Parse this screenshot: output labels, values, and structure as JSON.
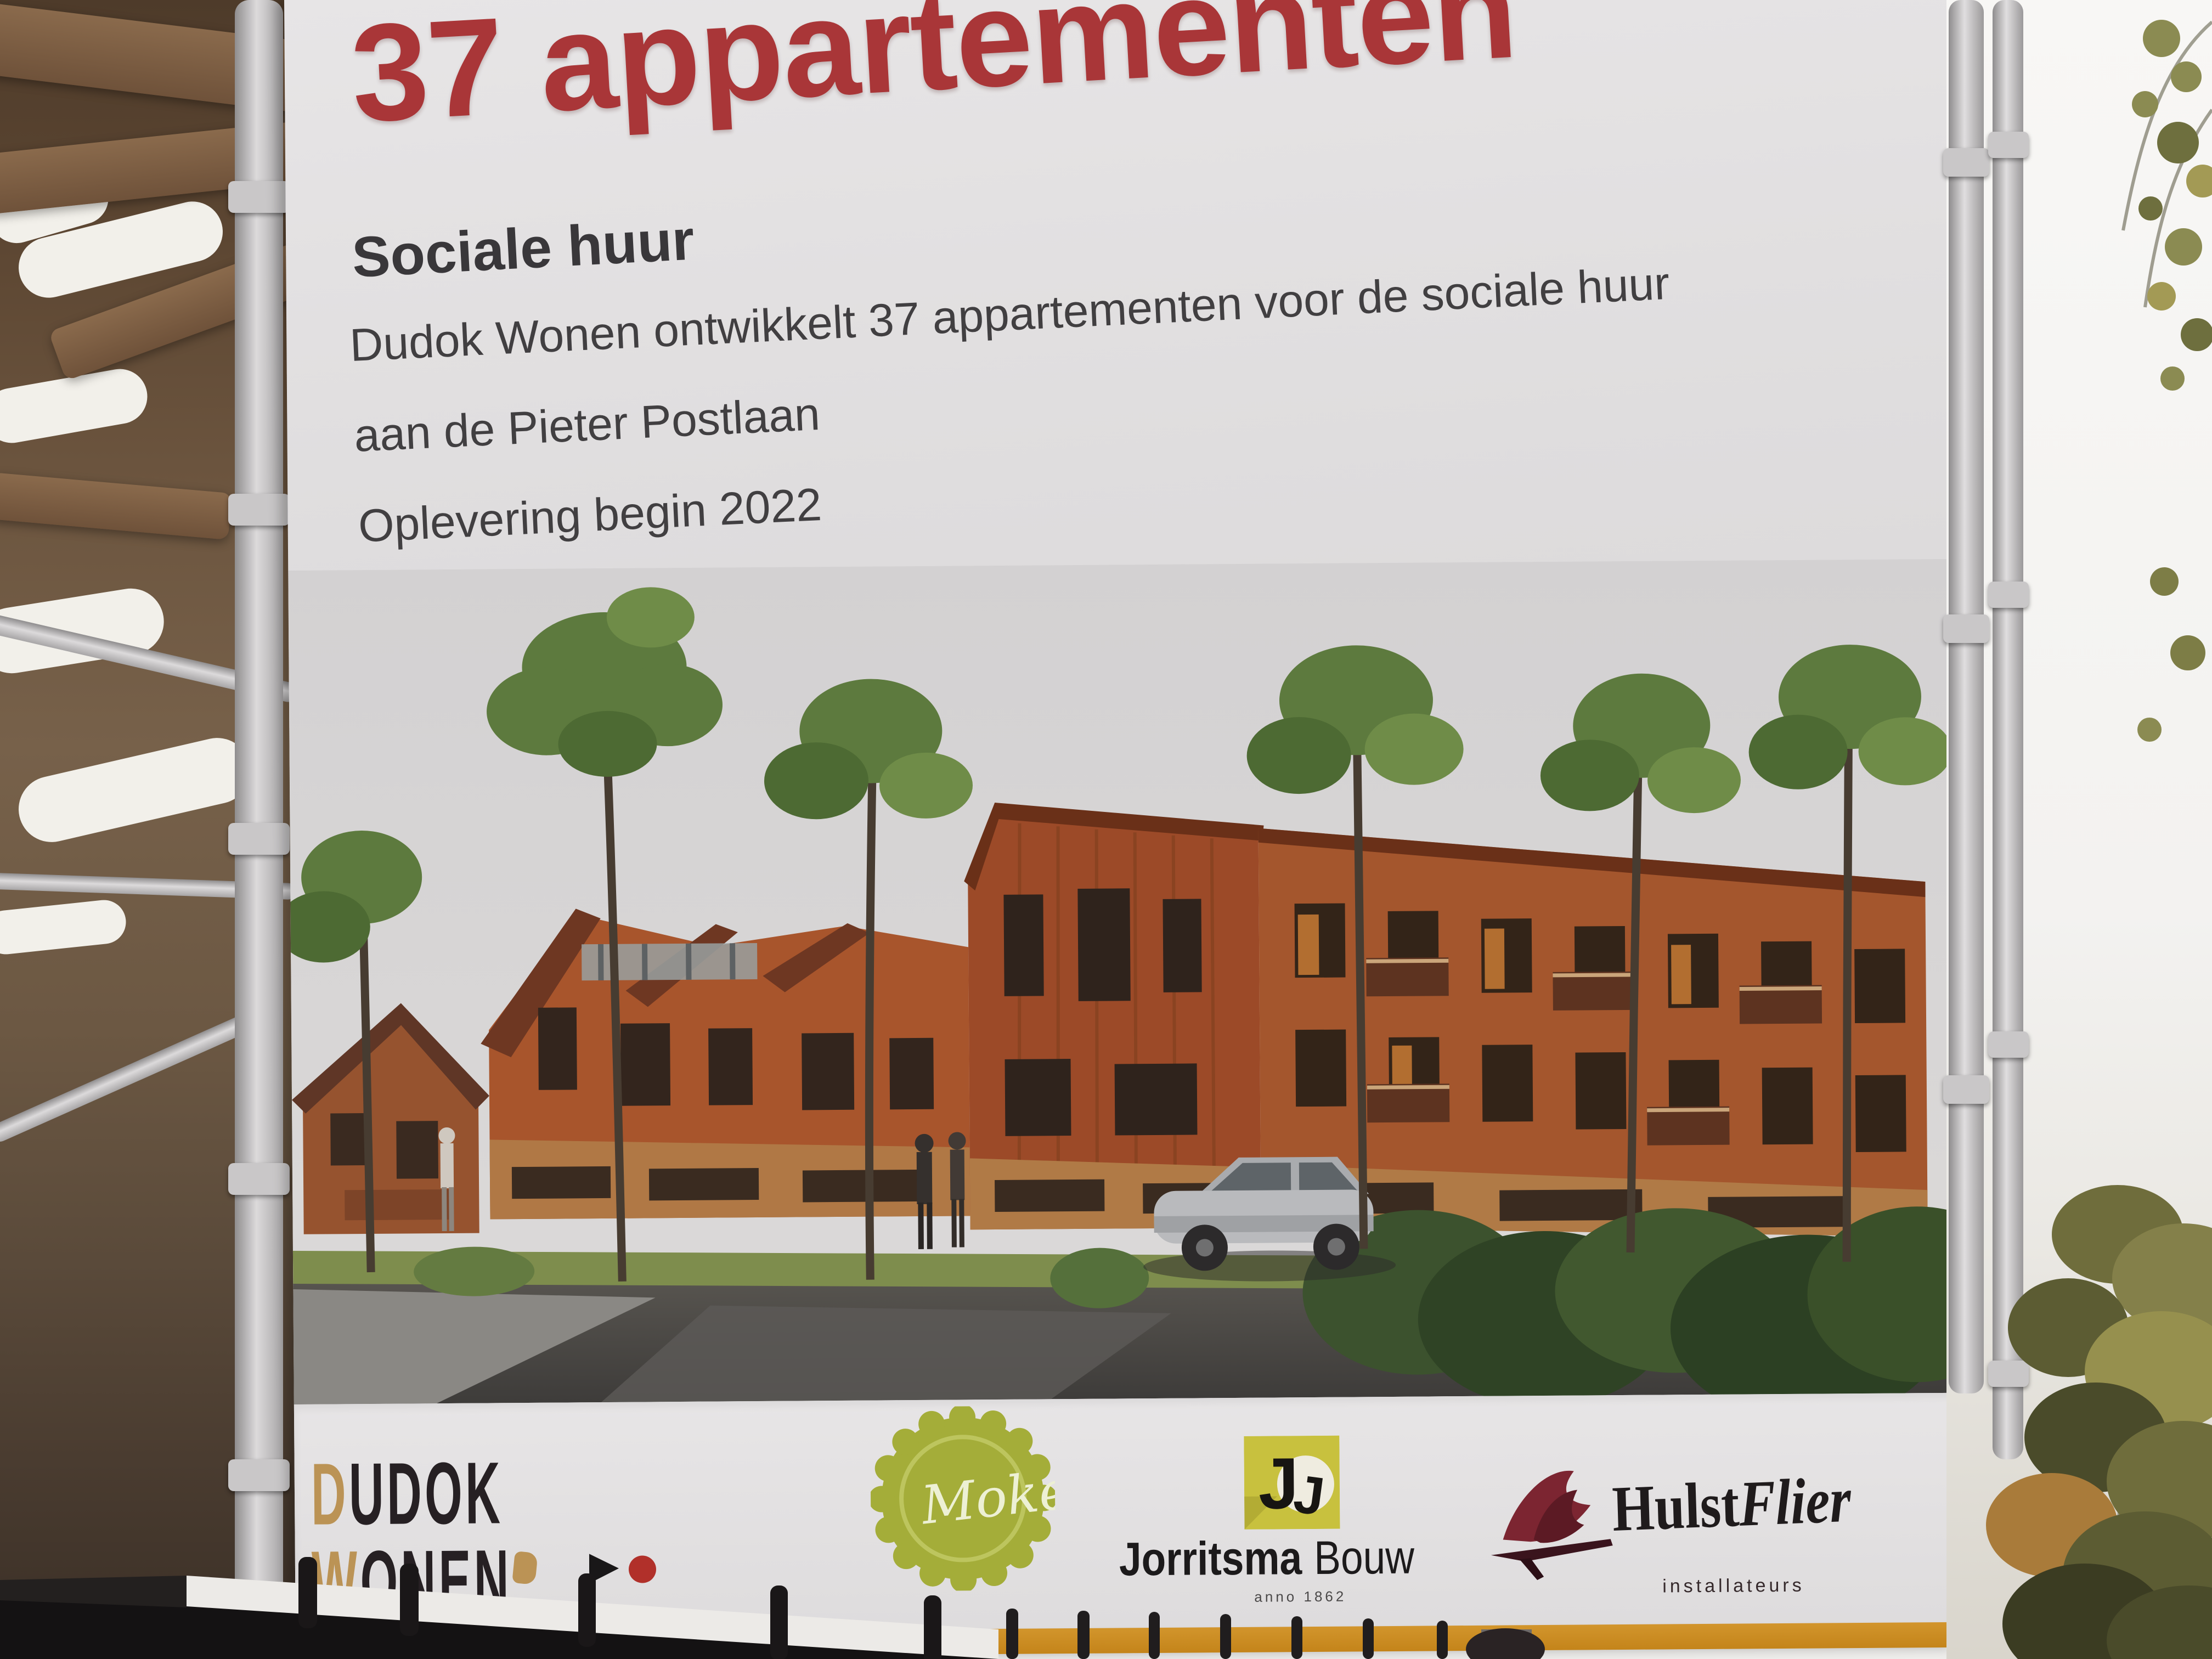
{
  "billboard": {
    "title": "37 appartementen",
    "subtitle": "Sociale huur",
    "body_line1": "Dudok Wonen ontwikkelt 37 appartementen voor de sociale huur",
    "body_line2": "aan de Pieter Postlaan",
    "body_line3": "Oplevering begin 2022"
  },
  "logo_strip": {
    "dudok": {
      "line1": "DUDOK",
      "line2": "WONEN",
      "tagline": "bindt mensen"
    },
    "moke": {
      "label": "Moke"
    },
    "jorritsma": {
      "monogram": "J",
      "name": "Jorritsma",
      "suffix": "Bouw",
      "tagline": "anno 1862"
    },
    "hulstflier": {
      "name_regular": "Hulst",
      "name_italic": "Flier",
      "subtitle": "installateurs"
    }
  },
  "colors": {
    "title_red": "#a93638",
    "dudok_gold": "#bb9355",
    "moke_green": "#a4ad39",
    "jorritsma_yellow": "#c8c13e",
    "hulstflier_red": "#7c2531",
    "banner_orange": "#c9881f"
  }
}
